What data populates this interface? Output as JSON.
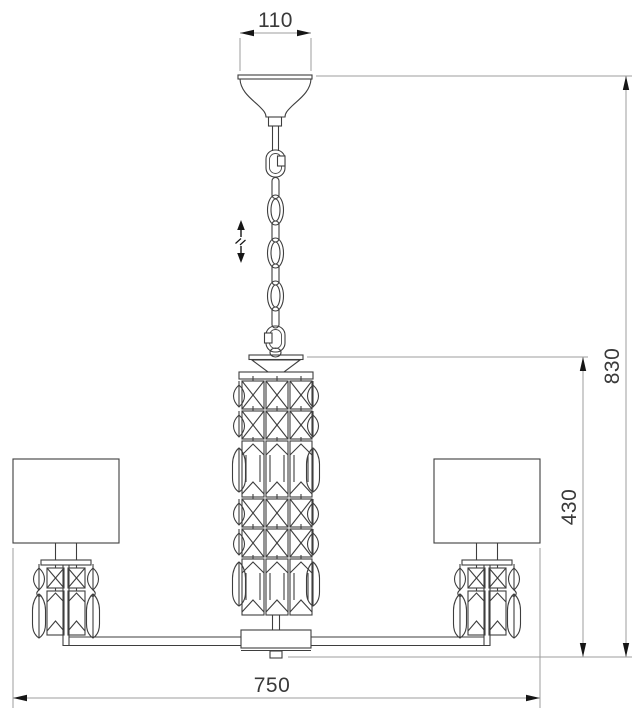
{
  "drawing": {
    "title": "chandelier-technical-dimension-drawing",
    "subject": "five-arm chandelier elevation with central crystal column, chain suspension and fabric shades",
    "dimensions": {
      "canopy_width": "110",
      "overall_height": "830",
      "crystal_column_height": "430",
      "overall_width": "750"
    },
    "symbols": {
      "height_adjustment": "up-down-arrow-icon"
    },
    "colors": {
      "background": "#ffffff",
      "object_line": "#3e3e3e",
      "dimension_line": "#9e9e9e",
      "arrow": "#161616",
      "text": "#3a3a3a"
    }
  }
}
